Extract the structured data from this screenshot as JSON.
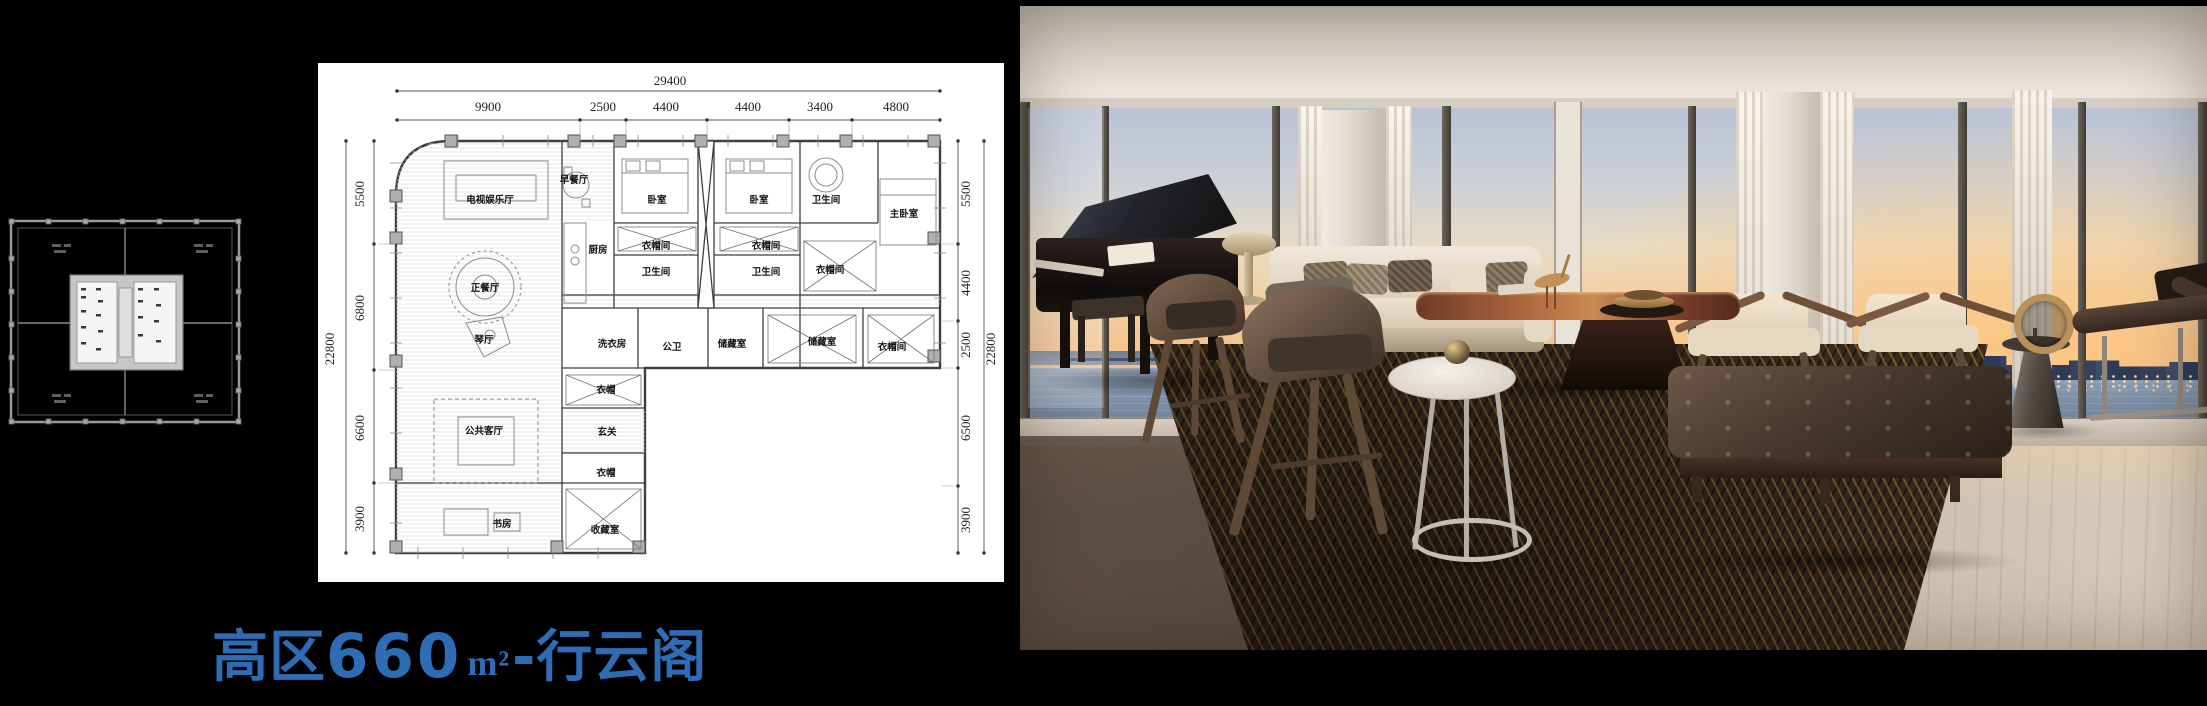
{
  "slide": {
    "title": {
      "prefix": "高区",
      "area": "660",
      "unit": "m²",
      "suffix": "-行云阁",
      "color": "#2e6cb5"
    }
  },
  "colors": {
    "background": "#000000",
    "title_blue": "#2e6cb5",
    "plan_lines": "#3f3f3f",
    "keyplan_gray": "#9a9a9a",
    "sunset_orange": "#f6bc83",
    "sky_blue": "#b9c3d6",
    "rug_brown": "#372a1d"
  },
  "floor_plan": {
    "dim_labels": [
      {
        "text": "29400",
        "x": 352,
        "y": 22
      },
      {
        "text": "9900",
        "x": 170,
        "y": 48
      },
      {
        "text": "2500",
        "x": 285,
        "y": 48
      },
      {
        "text": "4400",
        "x": 348,
        "y": 48
      },
      {
        "text": "4400",
        "x": 430,
        "y": 48
      },
      {
        "text": "3400",
        "x": 502,
        "y": 48
      },
      {
        "text": "4800",
        "x": 578,
        "y": 48
      },
      {
        "text": "22800",
        "x": 16,
        "y": 286,
        "rot": -90
      },
      {
        "text": "5500",
        "x": 46,
        "y": 131,
        "rot": -90
      },
      {
        "text": "6800",
        "x": 46,
        "y": 245,
        "rot": -90
      },
      {
        "text": "6600",
        "x": 46,
        "y": 365,
        "rot": -90
      },
      {
        "text": "3900",
        "x": 46,
        "y": 456,
        "rot": -90
      },
      {
        "text": "5500",
        "x": 652,
        "y": 131,
        "rot": -90
      },
      {
        "text": "4400",
        "x": 652,
        "y": 220,
        "rot": -90
      },
      {
        "text": "2500",
        "x": 652,
        "y": 282,
        "rot": -90
      },
      {
        "text": "6500",
        "x": 652,
        "y": 365,
        "rot": -90
      },
      {
        "text": "3900",
        "x": 652,
        "y": 457,
        "rot": -90
      },
      {
        "text": "22800",
        "x": 677,
        "y": 286,
        "rot": -90
      }
    ],
    "room_labels": [
      {
        "text": "电视娱乐厅",
        "x": 172,
        "y": 140
      },
      {
        "text": "正餐厅",
        "x": 167,
        "y": 228
      },
      {
        "text": "琴厅",
        "x": 166,
        "y": 280
      },
      {
        "text": "公共客厅",
        "x": 166,
        "y": 371
      },
      {
        "text": "书房",
        "x": 184,
        "y": 464
      },
      {
        "text": "早餐厅",
        "x": 256,
        "y": 120
      },
      {
        "text": "厨房",
        "x": 280,
        "y": 190
      },
      {
        "text": "卧室",
        "x": 339,
        "y": 140
      },
      {
        "text": "衣帽间",
        "x": 338,
        "y": 186
      },
      {
        "text": "卫生间",
        "x": 338,
        "y": 212
      },
      {
        "text": "卧室",
        "x": 441,
        "y": 140
      },
      {
        "text": "衣帽间",
        "x": 448,
        "y": 186
      },
      {
        "text": "卫生间",
        "x": 448,
        "y": 212
      },
      {
        "text": "卫生间",
        "x": 508,
        "y": 140
      },
      {
        "text": "主卧室",
        "x": 586,
        "y": 154
      },
      {
        "text": "衣帽间",
        "x": 512,
        "y": 210
      },
      {
        "text": "洗衣房",
        "x": 294,
        "y": 284
      },
      {
        "text": "公卫",
        "x": 354,
        "y": 287
      },
      {
        "text": "储藏室",
        "x": 414,
        "y": 284
      },
      {
        "text": "储藏室",
        "x": 504,
        "y": 282
      },
      {
        "text": "衣帽间",
        "x": 574,
        "y": 287
      },
      {
        "text": "衣帽",
        "x": 288,
        "y": 330
      },
      {
        "text": "玄关",
        "x": 289,
        "y": 372
      },
      {
        "text": "衣帽",
        "x": 288,
        "y": 413
      },
      {
        "text": "收藏室",
        "x": 287,
        "y": 470
      }
    ]
  }
}
